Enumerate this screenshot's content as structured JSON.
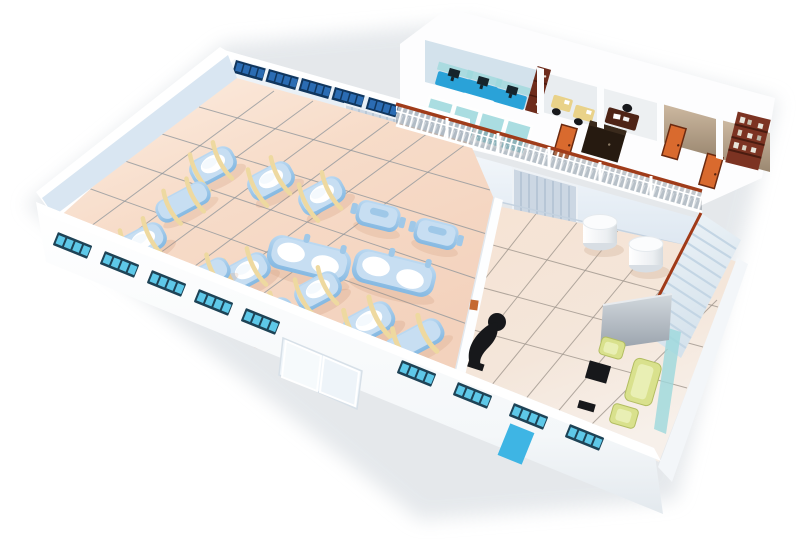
{
  "scene": {
    "label": "3D isometric cutaway illustration of a factory facility: production hall with machines, locker rooms, mezzanine offices, staircase and lounge area",
    "production_hall": {
      "machines": {
        "round_lid_vats": 8,
        "long_tanks": 3,
        "twin_vat_units": 2,
        "lidded_units": 2
      },
      "hose_note": "yellow flexible hoses draped over machines",
      "locker_rooms": {
        "rooms": 2,
        "stalls_per_room": 4,
        "stall_color_name": "blue",
        "door_color_name": "orange"
      },
      "back_window_groups": 5,
      "roller_door_on_back_wall": 1
    },
    "mezzanine": {
      "rooms": [
        {
          "name": "open-plan office",
          "workstations": 3,
          "computers": 3,
          "glass_partitions": 4
        },
        {
          "name": "admin office",
          "desks": 2,
          "cabinet": 1,
          "wardrobe": 1,
          "door_color_name": "orange"
        },
        {
          "name": "manager office",
          "desks": 1,
          "chairs": 1
        },
        {
          "name": "records room",
          "bookshelves": 1,
          "doors": 2
        }
      ],
      "railing_note": "white balustrade with red-brown handrail",
      "staircase_steps": 12
    },
    "ground_floor_right": {
      "round_tables": 2,
      "reception_desk": 1,
      "presentation_board": 1,
      "lounge": {
        "sofa": 1,
        "armchairs": 2,
        "coffee_table": 1,
        "bench": 1,
        "upholstery_color_name": "yellow-green"
      }
    },
    "exterior": {
      "front_window_strips": 9,
      "panes_per_strip": 4,
      "glass_sliding_door": 1,
      "blue_service_door": 1
    }
  },
  "colors": {
    "bg": "#ffffff",
    "shadow": "#dfe3e7",
    "wallWhite": "#ffffff",
    "wallInnerBlue": "#d9e6f2",
    "backWallTop": "#f2f6fa",
    "backWallBottom": "#dde8f2",
    "floorPeach": "#f5d9c6",
    "floorPeachLight": "#fdeee2",
    "floorRight": "#f3e3d6",
    "floorRightLight": "#f8f1ea",
    "tileLine": "#8d949a",
    "tileLineWarm": "#a0978e",
    "machineBlue": "#9fc8e8",
    "machineBlueDeep": "#7fb2dc",
    "machineBlueLight": "#c7def2",
    "machineWhite": "#ffffff",
    "hoseYellow": "#eed9a0",
    "winFrameFront": "#1e4356",
    "winPaneFront": "#5ec8e8",
    "winFrameBack": "#10365e",
    "winPaneBack": "#2b6cb3",
    "doorOrange": "#d96a2e",
    "doorOrangeDark": "#6b2a10",
    "garageGray": "#ccd7e3",
    "garageLine": "#aebfd0",
    "lockerBlue": "#2f73c8",
    "lockerBlue2": "#5b9bdd",
    "cubicleDesk": "#2aa2d8",
    "monitorDark": "#16242c",
    "glassTeal": "#9cd8dc",
    "cabinetBrown": "#6e2c1c",
    "wardrobeDark": "#261a10",
    "deskYellow": "#e9d289",
    "execBrown": "#4e2416",
    "chairBlack": "#17181b",
    "tanWall": "#c2ae97",
    "tanWallDark": "#93816a",
    "bookshelfBrown": "#7c3322",
    "railBrown": "#a03c1a",
    "railShadow": "#5a6470",
    "stairLight": "#e4edf4",
    "stairLine": "#c3d5e4",
    "stairRed": "#a03a18",
    "cylWhite": "#fbfcfd",
    "cylShade": "#d8dee4",
    "sofaGreen": "#d9e18d",
    "sofaGreenLight": "#e9efb4",
    "panelGray": "#aab2bb",
    "doorBlue": "#3eb5e4",
    "glassDoorWhite": "#eff5fa",
    "mezzFloor": "#eaf1f7"
  }
}
